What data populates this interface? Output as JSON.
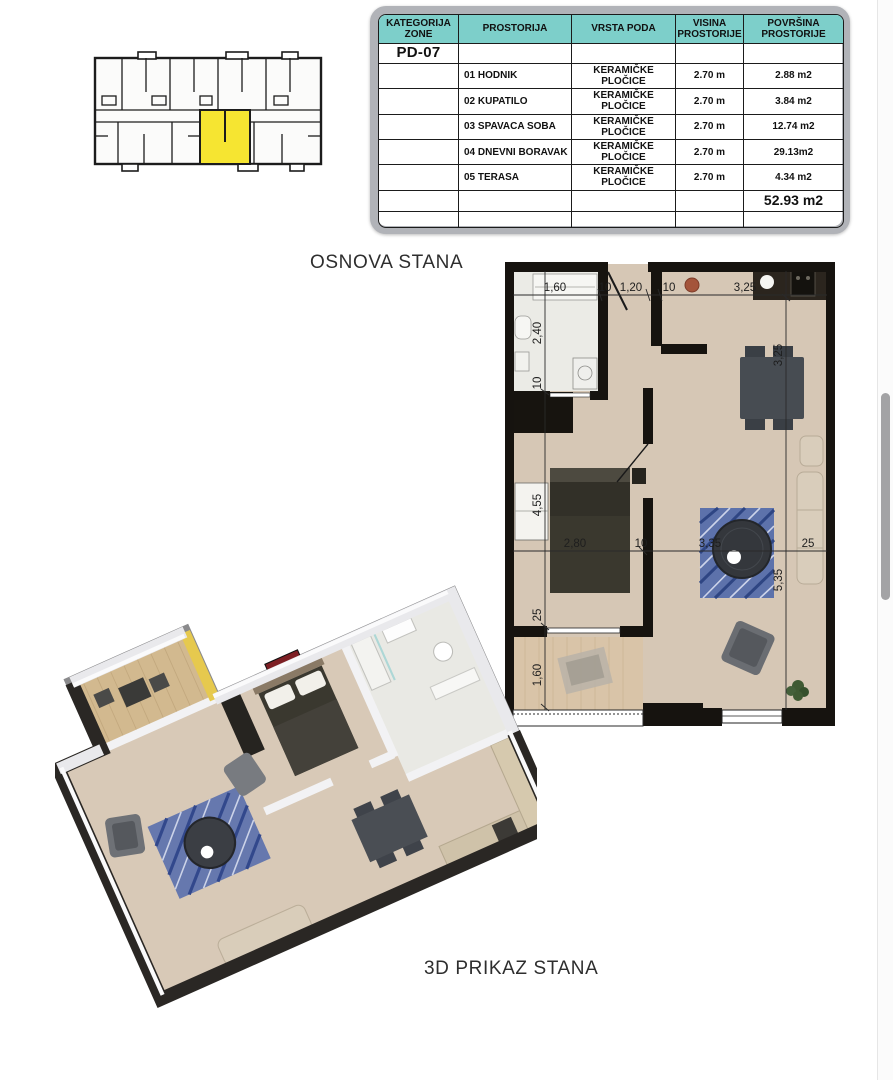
{
  "table": {
    "headers": [
      "KATEGORIJA ZONE",
      "PROSTORIJA",
      "VRSTA PODA",
      "VISINA PROSTORIJE",
      "POVRŠINA PROSTORIJE"
    ],
    "zone_code": "PD-07",
    "rows": [
      {
        "name": "01 HODNIK",
        "floor": "KERAMIČKE PLOČICE",
        "height": "2.70 m",
        "area": "2.88 m2"
      },
      {
        "name": "02 KUPATILO",
        "floor": "KERAMIČKE PLOČICE",
        "height": "2.70 m",
        "area": "3.84 m2"
      },
      {
        "name": "03 SPAVACA SOBA",
        "floor": "KERAMIČKE PLOČICE",
        "height": "2.70 m",
        "area": "12.74 m2"
      },
      {
        "name": "04 DNEVNI BORAVAK",
        "floor": "KERAMIČKE PLOČICE",
        "height": "2.70 m",
        "area": "29.13m2"
      },
      {
        "name": "05 TERASA",
        "floor": "KERAMIČKE PLOČICE",
        "height": "2.70 m",
        "area": "4.34 m2"
      }
    ],
    "total_area": "52.93 m2",
    "empty_row_count": 4,
    "header_bg": "#7dcfca"
  },
  "labels": {
    "plan2d_title": "OSNOVA STANA",
    "plan3d_title": "3D PRIKAZ STANA"
  },
  "building_overview": {
    "description": "building floor overview with highlighted unit",
    "highlight_color": "#f6e531"
  },
  "plan2d": {
    "dims_top": [
      "1,60",
      "10",
      "1,20",
      "10",
      "3,25"
    ],
    "dims_left": [
      "2,40",
      "10",
      "4,55",
      "25",
      "1,60"
    ],
    "dims_mid": [
      "2,80",
      "10",
      "3,35",
      "25"
    ],
    "dims_right": [
      "3,25",
      "5,35"
    ],
    "colors": {
      "wall": "#16130f",
      "floor": "#d6c7b5",
      "bathroom": "#ececе7",
      "terrace": "#d9c4a8",
      "rug": "#5d72ab"
    }
  },
  "scrollbar": {
    "thumb_color": "#a3a3a5"
  }
}
